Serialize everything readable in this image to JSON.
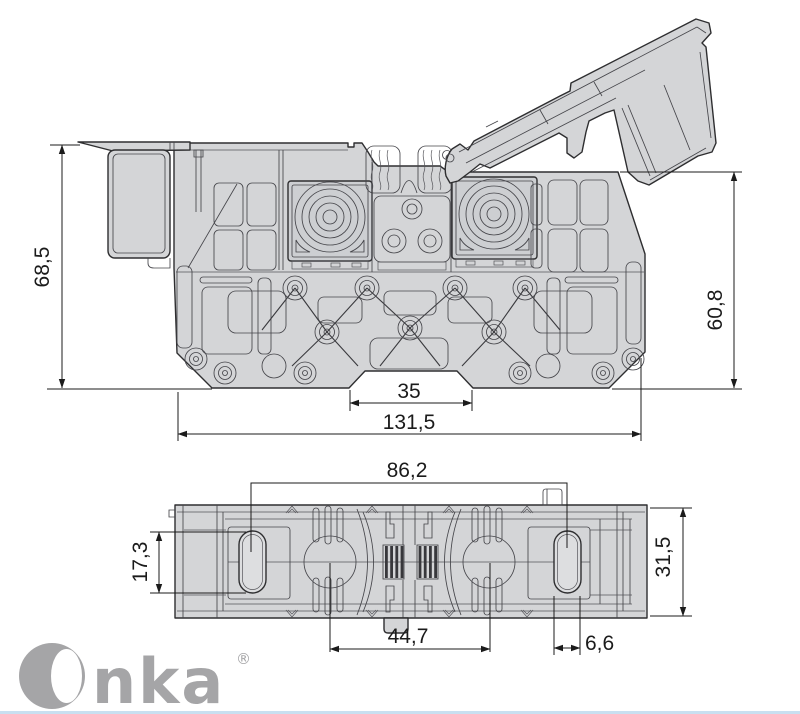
{
  "page": {
    "background": "#ffffff",
    "bottom_accent_color": "#c9dff0"
  },
  "drawing": {
    "kind": "technical dimension drawing",
    "subject": "DIN-rail terminal block with open hinged cover, side and plan views",
    "body_fill": "#d4d5d7",
    "panel_fill": "#cdcfd2",
    "slot_fill": "#e2e3e5",
    "line_color": "#2e2e30",
    "dim_color": "#1b1b1b"
  },
  "dimensions": {
    "side_view": {
      "height_left": "68,5",
      "height_right": "60,8",
      "rail_notch_width": "35",
      "total_length": "131,5"
    },
    "plan_view": {
      "hole_spacing": "86,2",
      "slot_height": "17,3",
      "total_width": "31,5",
      "pad_spacing": "44,7",
      "slot_width": "6,6"
    }
  },
  "brand": {
    "logo_text": "nka",
    "registered_mark": "®",
    "logo_color": "#a5a5a7"
  }
}
